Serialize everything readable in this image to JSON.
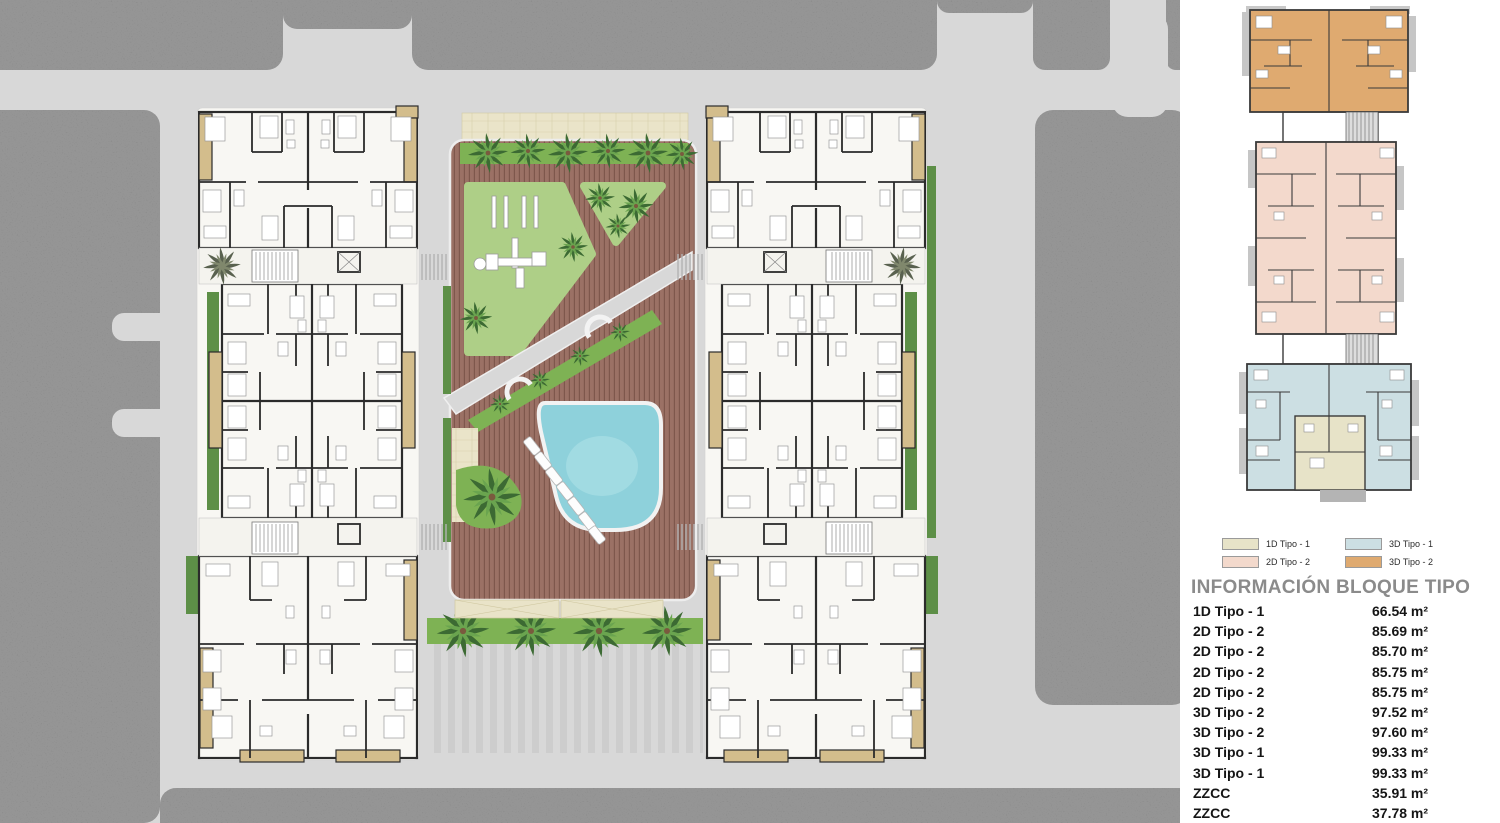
{
  "legend": {
    "items": [
      {
        "label": "1D Tipo - 1",
        "color": "#e7e3c8"
      },
      {
        "label": "2D Tipo - 2",
        "color": "#f3d9cc"
      },
      {
        "label": "3D Tipo - 1",
        "color": "#ccdfe3"
      },
      {
        "label": "3D Tipo - 2",
        "color": "#dfaa70"
      }
    ]
  },
  "info": {
    "title": "INFORMACIÓN BLOQUE TIPO",
    "rows": [
      {
        "label": "1D Tipo - 1",
        "area": "66.54 m²"
      },
      {
        "label": "2D Tipo - 2",
        "area": "85.69 m²"
      },
      {
        "label": "2D Tipo - 2",
        "area": "85.70 m²"
      },
      {
        "label": "2D Tipo - 2",
        "area": "85.75 m²"
      },
      {
        "label": "2D Tipo - 2",
        "area": "85.75 m²"
      },
      {
        "label": "3D Tipo - 2",
        "area": "97.52 m²"
      },
      {
        "label": "3D Tipo - 2",
        "area": "97.60 m²"
      },
      {
        "label": "3D Tipo - 1",
        "area": "99.33 m²"
      },
      {
        "label": "3D Tipo - 1",
        "area": "99.33 m²"
      },
      {
        "label": "ZZCC",
        "area": "35.91 m²"
      },
      {
        "label": "ZZCC",
        "area": "37.78 m²"
      }
    ]
  },
  "palette": {
    "asphalt": "#7d7d7d",
    "road": "#d8d8d8",
    "deck": "#9b7165",
    "lawn": "#aecf87",
    "hedge": "#5d8f47",
    "pool": "#8ed1db",
    "building_floor": "#e6ddbe",
    "balcony": "#d3bd8c",
    "core_gray": "#b4b4b4",
    "wall": "#2b2b2b"
  }
}
